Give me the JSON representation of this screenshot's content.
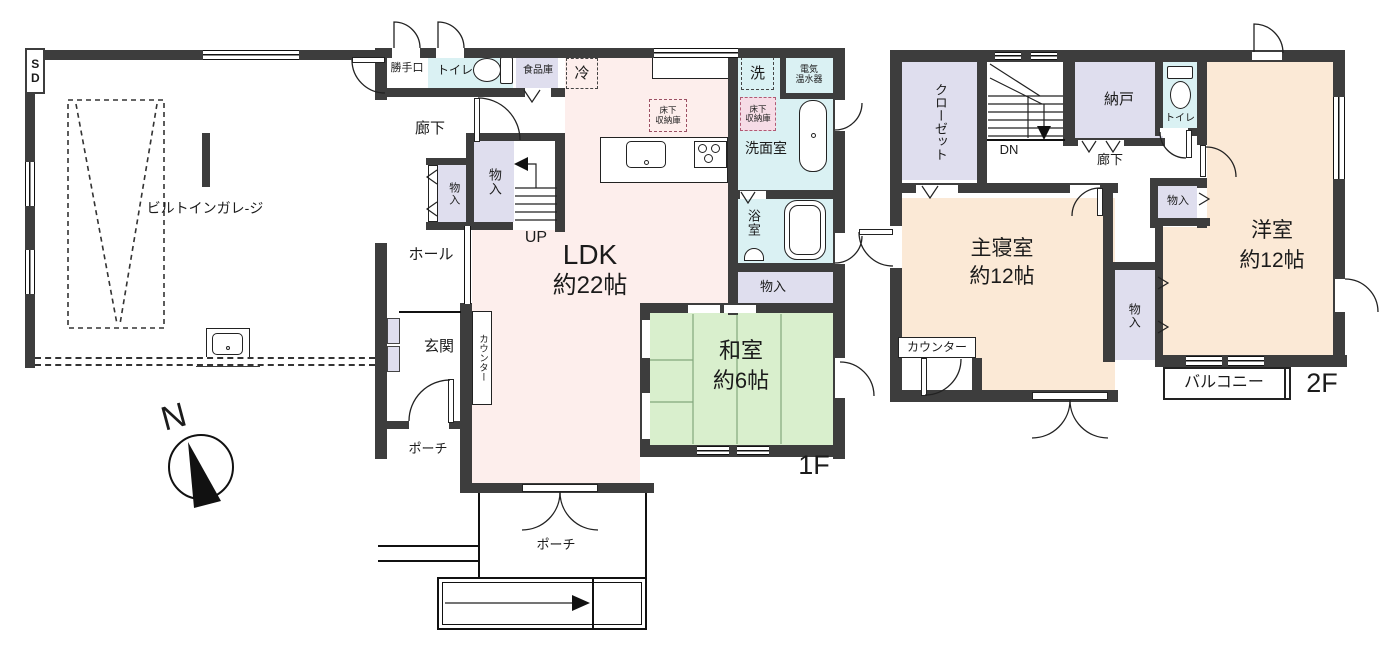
{
  "plan": {
    "floor1_label": "1F",
    "floor2_label": "2F",
    "compass_n": "N",
    "garage": {
      "name": "ビルトインガレ-ジ",
      "shutter": "SD"
    },
    "f1": {
      "katteguchi": "勝手口",
      "toilet": "トイレ",
      "pantry": "食品庫",
      "fridge": "冷",
      "corridor": "廊下",
      "storage_small": "物入",
      "storage_large": "物入",
      "stairs_up": "UP",
      "ldk": "LDK",
      "ldk_size": "約22帖",
      "underfloor_l1": "床下",
      "underfloor_l2": "収納庫",
      "laundry": "洗",
      "heater_l1": "電気",
      "heater_l2": "温水器",
      "washroom": "洗面室",
      "bathroom": "浴室",
      "storage_bath": "物入",
      "washitsu": "和室",
      "washitsu_size": "約6帖",
      "hall": "ホール",
      "entrance": "玄関",
      "counter": "カウンター",
      "porch_side": "ポーチ",
      "porch_main": "ポーチ"
    },
    "f2": {
      "closet": "クローゼット",
      "stairs_down": "DN",
      "storage_room": "納戸",
      "toilet": "トイレ",
      "corridor": "廊下",
      "storage_small": "物入",
      "storage_mid": "物入",
      "master": "主寝室",
      "master_size": "約12帖",
      "western": "洋室",
      "western_size": "約12帖",
      "counter": "カウンター",
      "balcony": "バルコニー"
    },
    "colors": {
      "wall": "#3d3d3d",
      "ldk": "#fdeeec",
      "tatami": "#d9efcd",
      "bedroom": "#fbe9d6",
      "wet": "#daf1f3",
      "storage": "#dfdeee",
      "underfloor_pink": "#f6dce6"
    }
  }
}
